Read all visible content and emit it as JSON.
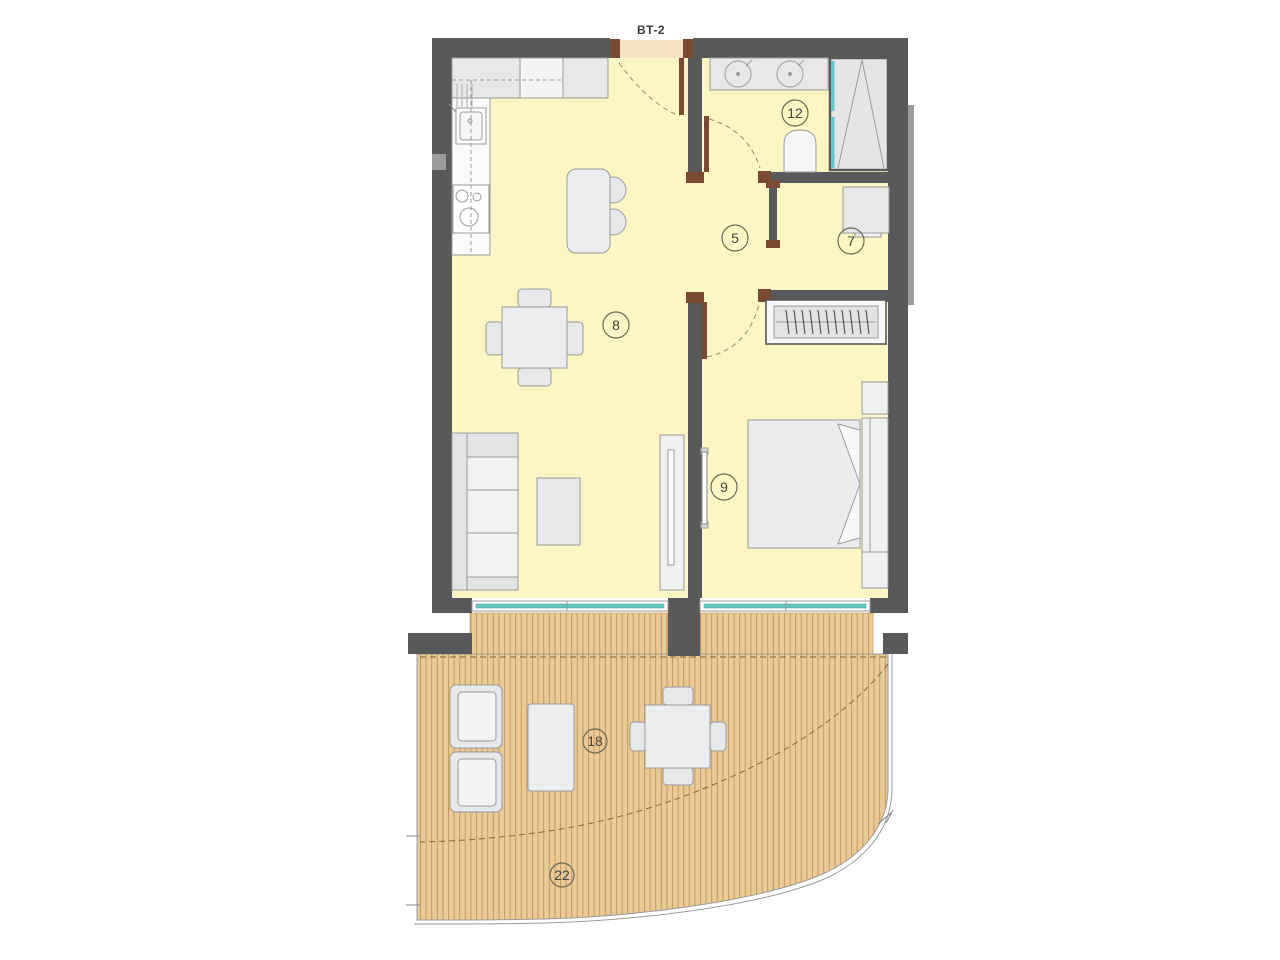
{
  "plan": {
    "unit_label": "BT-2",
    "rooms": [
      {
        "key": "hallway",
        "number": "5"
      },
      {
        "key": "storage",
        "number": "7"
      },
      {
        "key": "living-kitchen",
        "number": "8"
      },
      {
        "key": "bedroom",
        "number": "9"
      },
      {
        "key": "bathroom",
        "number": "12"
      },
      {
        "key": "terrace-upper",
        "number": "18"
      },
      {
        "key": "terrace-lower",
        "number": "22"
      }
    ],
    "colors": {
      "wall": "#58595B",
      "floor": "#FBF6C3",
      "entrance_threshold": "#F7E2C6",
      "deck_wood": "#EACA96",
      "deck_slat": "#C49A5F",
      "glass": "#66C6C1",
      "door_wood": "#7A4B33",
      "furniture_fill": "#E7E8E9",
      "furniture_stroke": "#9A9A9A"
    }
  }
}
